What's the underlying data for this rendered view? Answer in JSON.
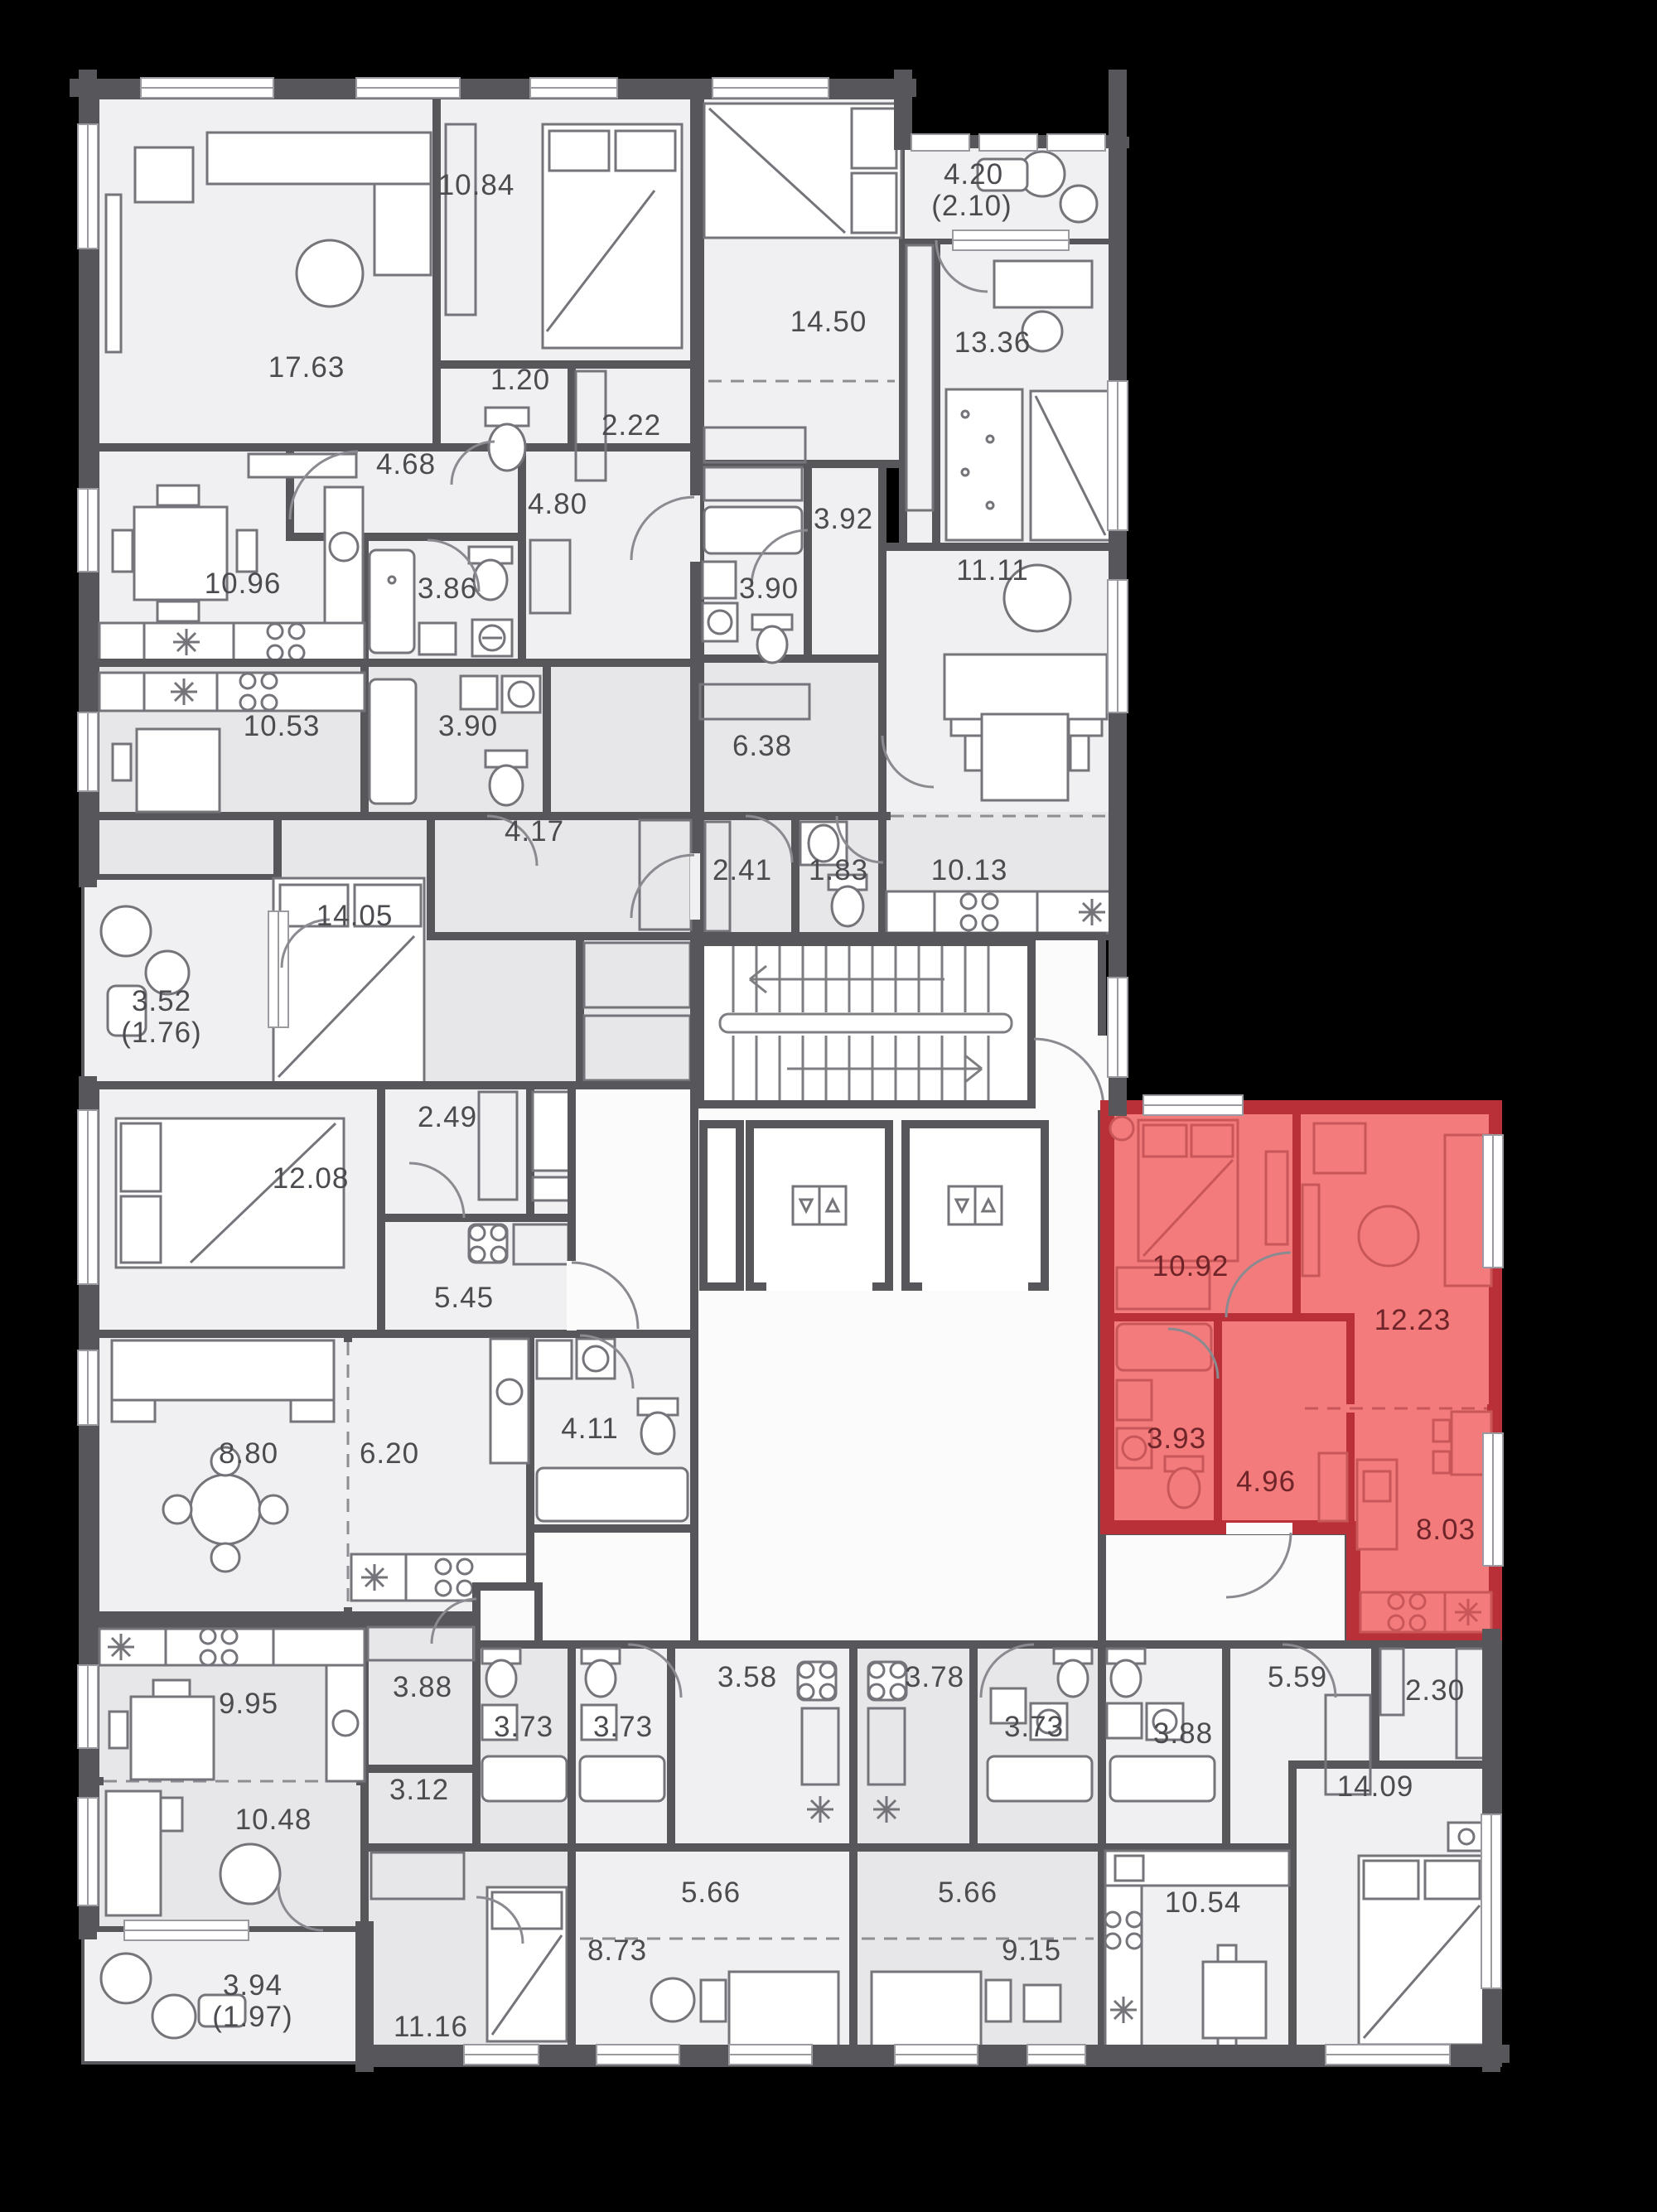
{
  "plan_title": "residential floor plan with highlighted apartment",
  "colors": {
    "background": "#000000",
    "walls": "#57575b",
    "highlight_walls": "#b93038",
    "highlight_fill": "#f37b7b",
    "room_fill_light": "#f0f0f2",
    "room_fill_mid": "#e7e7e9",
    "label_text": "#4b4b50",
    "highlight_label_text": "#6e2428"
  },
  "rooms": {
    "a1_living": "17.63",
    "a1_bedroom": "10.84",
    "a1_wc": "1.20",
    "a1_wardrobe": "2.22",
    "a1_hall": "4.68",
    "a1_kitchen": "10.96",
    "a1_bath": "3.86",
    "a1_hall2": "4.80",
    "a2_kitchen": "10.53",
    "a2_bath": "3.90",
    "a2_hall": "4.17",
    "a2_bedroom": "14.05",
    "a2_balcony": "3.52",
    "a2_balcony_half": "(1.76)",
    "a3_bedroom": "12.08",
    "a3_wardrobe": "2.49",
    "a3_hall": "5.45",
    "a3_living": "8.80",
    "a3_kitchen": "6.20",
    "a3_bath": "4.11",
    "b1_bedroom": "14.50",
    "b1_child": "13.36",
    "b1_balcony": "4.20",
    "b1_balcony_half": "(2.10)",
    "b1_ward": "3.92",
    "b1_bath": "3.90",
    "b1_living": "11.11",
    "b1_hall": "6.38",
    "b1_ward2": "2.41",
    "b1_wc": "1.83",
    "b1_kitchen": "10.13",
    "red_bedroom": "10.92",
    "red_living": "12.23",
    "red_bath": "3.93",
    "red_hall": "4.96",
    "red_kitchen": "8.03",
    "c1_kitchen": "9.95",
    "c1_ward": "3.88",
    "c1_living": "10.48",
    "c1_hall": "3.12",
    "c1_bath": "3.73",
    "c1_bedroom": "11.16",
    "c1_balcony": "3.94",
    "c1_balcony_half": "(1.97)",
    "sb_bath": "3.73",
    "sb_kitchen": "3.58",
    "sb_hall": "5.66",
    "sb_living": "8.73",
    "sc_kitchen": "3.78",
    "sc_bath": "3.73",
    "sc_hall": "5.66",
    "sc_living": "9.15",
    "d_bath": "3.88",
    "d_hall": "5.59",
    "d_ward": "2.30",
    "d_living": "10.54",
    "d_bedroom": "14.09"
  }
}
